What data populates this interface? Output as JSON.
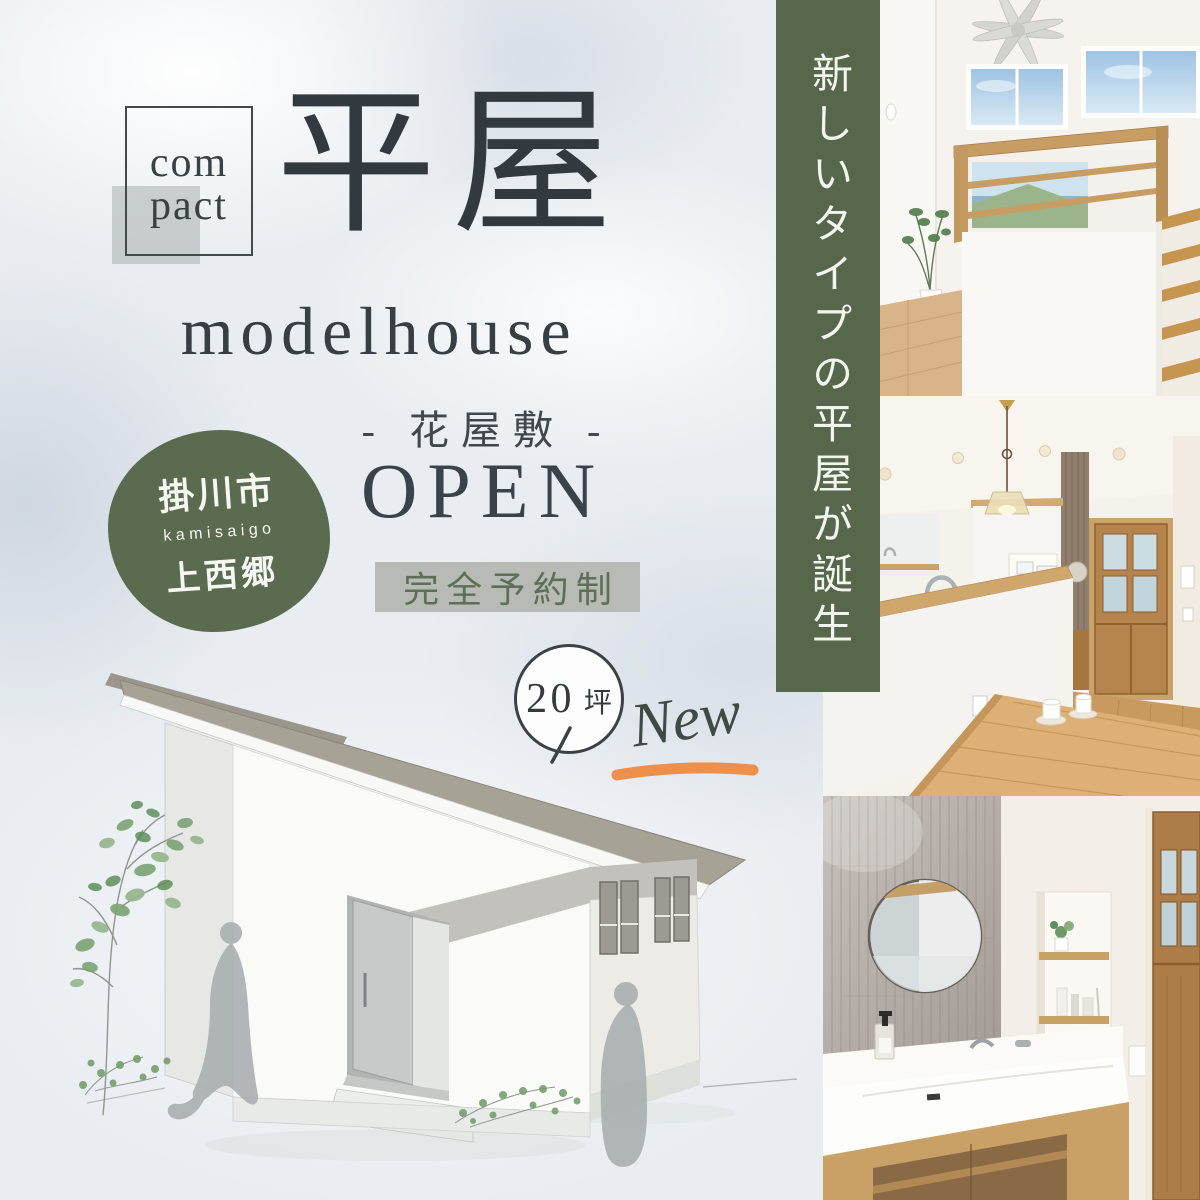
{
  "poster": {
    "background": "#e9edf1",
    "accent_green": "#57674c",
    "accent_orange": "#ef8f4c",
    "ink": "#3a4247"
  },
  "compact_badge": {
    "line1": "com",
    "line2": "pact"
  },
  "title": {
    "kanji": "平屋",
    "latin": "modelhouse"
  },
  "venue": {
    "name_line": "- 花屋敷 -",
    "open_label": "OPEN",
    "reservation_label": "完全予約制"
  },
  "location_badge": {
    "city": "掛川市",
    "romaji": "kamisaigo",
    "district": "上西郷"
  },
  "area_badge": {
    "value": "20",
    "unit": "坪"
  },
  "new_label": "New",
  "side_banner": {
    "text": "新しいタイプの平屋が誕生"
  },
  "photos": [
    {
      "id": "loft-interior",
      "alt": "Interior with ceiling fan, high sky windows, wood railing and stairs"
    },
    {
      "id": "kitchen-counter",
      "alt": "Kitchen with brass pendant light, wood counters and glass-paned wooden door"
    },
    {
      "id": "washroom-vanity",
      "alt": "Washroom vanity with round mirror, gray tiled wall and wood cabinet"
    }
  ]
}
